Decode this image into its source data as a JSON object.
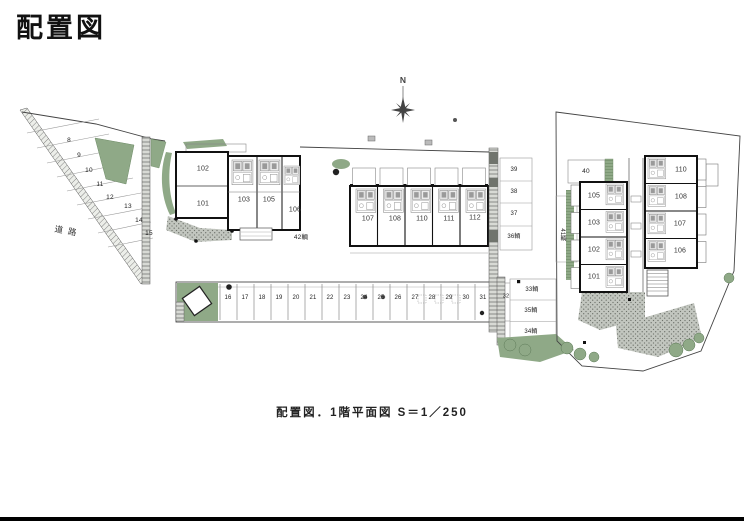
{
  "page": {
    "title": "配置図",
    "caption": "配置図．1階平面図 S＝1／250"
  },
  "compass": {
    "north_label": "N"
  },
  "site": {
    "road_label": "道路",
    "west_parking_stalls": [
      "8",
      "9",
      "10",
      "11",
      "12",
      "13",
      "14",
      "15"
    ],
    "center_parking_stalls": [
      "16",
      "17",
      "18",
      "19",
      "20",
      "21",
      "22",
      "23",
      "24",
      "25",
      "26",
      "27",
      "28",
      "29",
      "30",
      "31",
      "32"
    ],
    "east_column_stalls": [
      "39",
      "38",
      "37",
      "36輌"
    ],
    "south_column_stalls": [
      "33輌",
      "35輌",
      "34輌"
    ],
    "stall_40": "40",
    "stall_41": "41輌",
    "stall_42": "42輌"
  },
  "west_building": {
    "units": [
      "102",
      "101",
      "103",
      "105",
      "106"
    ]
  },
  "center_building": {
    "units": [
      "107",
      "108",
      "110",
      "111",
      "112"
    ]
  },
  "east_building": {
    "west_units": [
      "105",
      "103",
      "102",
      "101"
    ],
    "east_units": [
      "110",
      "108",
      "107",
      "106"
    ]
  },
  "colors": {
    "landscape_green": "#8fa987",
    "paving_gray": "#c2c6bf",
    "line": "#222222"
  }
}
